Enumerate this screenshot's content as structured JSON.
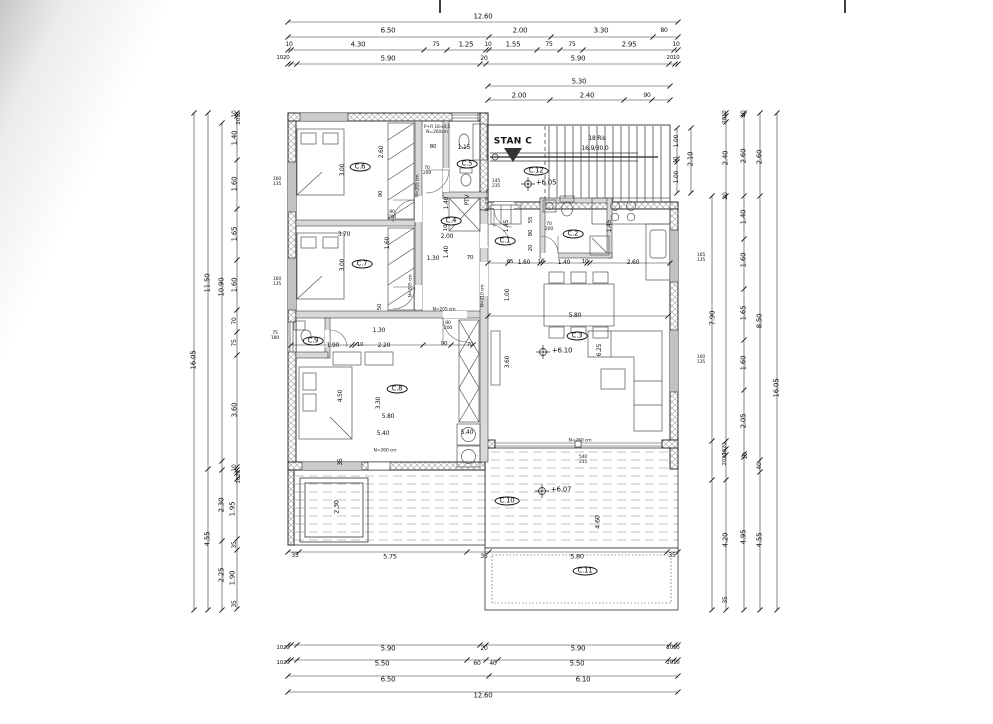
{
  "plan": {
    "title": "STAN C"
  },
  "stairs": {
    "line1": "18 Ris",
    "line2": "16.9/30.0"
  },
  "rooms": [
    "C.1",
    "C.2",
    "C.3",
    "C.4",
    "C.5",
    "C.6",
    "C.7",
    "C.8",
    "C.9",
    "C.10",
    "C.11",
    "C.12"
  ],
  "levels": [
    "+6.05",
    "+6.10",
    "+6.07"
  ],
  "colors": {
    "line": "#1a1a1a",
    "hatch": "#b0b0b0",
    "furniture": "#555555",
    "paper": "#ffffff"
  },
  "labels": [
    {
      "t": "12.60",
      "x": 483,
      "y": 17
    },
    {
      "t": "6.50",
      "x": 388,
      "y": 31
    },
    {
      "t": "2.00",
      "x": 520,
      "y": 31
    },
    {
      "t": "3.30",
      "x": 601,
      "y": 31
    },
    {
      "t": "80",
      "x": 664,
      "y": 31,
      "s": 6
    },
    {
      "t": "10",
      "x": 289,
      "y": 45,
      "s": 6
    },
    {
      "t": "4.30",
      "x": 358,
      "y": 45
    },
    {
      "t": "75",
      "x": 436,
      "y": 45,
      "s": 6
    },
    {
      "t": "1.25",
      "x": 466,
      "y": 45
    },
    {
      "t": "10",
      "x": 488,
      "y": 45,
      "s": 6
    },
    {
      "t": "1.55",
      "x": 513,
      "y": 45
    },
    {
      "t": "75",
      "x": 549,
      "y": 45,
      "s": 6
    },
    {
      "t": "75",
      "x": 572,
      "y": 45,
      "s": 6
    },
    {
      "t": "2.95",
      "x": 629,
      "y": 45
    },
    {
      "t": "10",
      "x": 676,
      "y": 45,
      "s": 6
    },
    {
      "t": "1020",
      "x": 283,
      "y": 59,
      "s": 5.5
    },
    {
      "t": "5.90",
      "x": 388,
      "y": 59
    },
    {
      "t": "20",
      "x": 484,
      "y": 59,
      "s": 6
    },
    {
      "t": "5.90",
      "x": 578,
      "y": 59
    },
    {
      "t": "2010",
      "x": 673,
      "y": 59,
      "s": 5.5
    },
    {
      "t": "5.30",
      "x": 579,
      "y": 82
    },
    {
      "t": "2.00",
      "x": 519,
      "y": 96
    },
    {
      "t": "2.40",
      "x": 587,
      "y": 96
    },
    {
      "t": "90",
      "x": 647,
      "y": 96,
      "s": 6
    },
    {
      "t": "1020",
      "x": 283,
      "y": 649,
      "s": 5.5
    },
    {
      "t": "5.90",
      "x": 388,
      "y": 649
    },
    {
      "t": "20",
      "x": 484,
      "y": 649,
      "s": 6
    },
    {
      "t": "5.90",
      "x": 578,
      "y": 649
    },
    {
      "t": "2010",
      "x": 673,
      "y": 649,
      "s": 5.5
    },
    {
      "t": "1020",
      "x": 283,
      "y": 664,
      "s": 5.5
    },
    {
      "t": "5.50",
      "x": 382,
      "y": 664
    },
    {
      "t": "60",
      "x": 477,
      "y": 664,
      "s": 6
    },
    {
      "t": "40",
      "x": 493,
      "y": 664,
      "s": 6
    },
    {
      "t": "5.50",
      "x": 577,
      "y": 664
    },
    {
      "t": "2010",
      "x": 673,
      "y": 664,
      "s": 5.5
    },
    {
      "t": "6.50",
      "x": 388,
      "y": 680
    },
    {
      "t": "6.10",
      "x": 583,
      "y": 680
    },
    {
      "t": "12.60",
      "x": 483,
      "y": 696
    },
    {
      "t": "16.05",
      "x": 194,
      "y": 360,
      "v": 1
    },
    {
      "t": "11.50",
      "x": 208,
      "y": 283,
      "v": 1
    },
    {
      "t": "4.55",
      "x": 208,
      "y": 539,
      "v": 1
    },
    {
      "t": "10.90",
      "x": 222,
      "y": 287,
      "v": 1
    },
    {
      "t": "2.30",
      "x": 222,
      "y": 505,
      "v": 1
    },
    {
      "t": "2.25",
      "x": 222,
      "y": 575,
      "v": 1
    },
    {
      "t": "2010",
      "x": 240,
      "y": 118,
      "v": 1,
      "s": 5.5
    },
    {
      "t": "10",
      "x": 235,
      "y": 114,
      "v": 1,
      "s": 6
    },
    {
      "t": "1.40",
      "x": 235,
      "y": 138,
      "v": 1
    },
    {
      "t": "1.60",
      "x": 235,
      "y": 184,
      "v": 1
    },
    {
      "t": "1.65",
      "x": 235,
      "y": 234,
      "v": 1
    },
    {
      "t": "1.60",
      "x": 235,
      "y": 285,
      "v": 1
    },
    {
      "t": "70",
      "x": 235,
      "y": 321,
      "v": 1,
      "s": 6
    },
    {
      "t": "75",
      "x": 235,
      "y": 343,
      "v": 1,
      "s": 6
    },
    {
      "t": "3.60",
      "x": 235,
      "y": 410,
      "v": 1
    },
    {
      "t": "10",
      "x": 235,
      "y": 468,
      "v": 1,
      "s": 6
    },
    {
      "t": "1020",
      "x": 240,
      "y": 477,
      "v": 1,
      "s": 5.5
    },
    {
      "t": "1.95",
      "x": 233,
      "y": 509,
      "v": 1
    },
    {
      "t": "35",
      "x": 235,
      "y": 545,
      "v": 1,
      "s": 6
    },
    {
      "t": "1.90",
      "x": 233,
      "y": 578,
      "v": 1
    },
    {
      "t": "35",
      "x": 235,
      "y": 604,
      "v": 1,
      "s": 6
    },
    {
      "t": "1.00",
      "x": 677,
      "y": 141,
      "v": 1,
      "s": 6
    },
    {
      "t": "10",
      "x": 677,
      "y": 160,
      "v": 1,
      "s": 5.5
    },
    {
      "t": "1.00",
      "x": 677,
      "y": 177,
      "v": 1,
      "s": 6
    },
    {
      "t": "2.10",
      "x": 691,
      "y": 159,
      "v": 1
    },
    {
      "t": "2010",
      "x": 726,
      "y": 117,
      "v": 1,
      "s": 5.5
    },
    {
      "t": "2.40",
      "x": 726,
      "y": 158,
      "v": 1
    },
    {
      "t": "20",
      "x": 726,
      "y": 196,
      "v": 1,
      "s": 6
    },
    {
      "t": "7.90",
      "x": 713,
      "y": 318,
      "v": 1
    },
    {
      "t": "1020",
      "x": 726,
      "y": 449,
      "v": 1,
      "s": 5.5
    },
    {
      "t": "2020",
      "x": 726,
      "y": 459,
      "v": 1,
      "s": 5.5
    },
    {
      "t": "4.20",
      "x": 726,
      "y": 540,
      "v": 1
    },
    {
      "t": "35",
      "x": 726,
      "y": 600,
      "v": 1,
      "s": 6
    },
    {
      "t": "10",
      "x": 744,
      "y": 114,
      "v": 1,
      "s": 6
    },
    {
      "t": "2.60",
      "x": 744,
      "y": 156,
      "v": 1
    },
    {
      "t": "1.40",
      "x": 744,
      "y": 217,
      "v": 1
    },
    {
      "t": "1.60",
      "x": 744,
      "y": 260,
      "v": 1
    },
    {
      "t": "1.65",
      "x": 744,
      "y": 313,
      "v": 1
    },
    {
      "t": "1.60",
      "x": 744,
      "y": 363,
      "v": 1
    },
    {
      "t": "2.05",
      "x": 744,
      "y": 421,
      "v": 1
    },
    {
      "t": "10",
      "x": 746,
      "y": 456,
      "v": 1,
      "s": 6
    },
    {
      "t": "4.95",
      "x": 744,
      "y": 537,
      "v": 1
    },
    {
      "t": "2.60",
      "x": 760,
      "y": 157,
      "v": 1
    },
    {
      "t": "8.50",
      "x": 760,
      "y": 321,
      "v": 1
    },
    {
      "t": "40",
      "x": 760,
      "y": 466,
      "v": 1,
      "s": 6
    },
    {
      "t": "4.55",
      "x": 760,
      "y": 540,
      "v": 1
    },
    {
      "t": "16.05",
      "x": 777,
      "y": 388,
      "v": 1
    },
    {
      "t": "C.1",
      "x": 505,
      "y": 241,
      "k": "room"
    },
    {
      "t": "C.2",
      "x": 573,
      "y": 234,
      "k": "room"
    },
    {
      "t": "C.3",
      "x": 577,
      "y": 336,
      "k": "room"
    },
    {
      "t": "C.4",
      "x": 451,
      "y": 221,
      "k": "room"
    },
    {
      "t": "C.5",
      "x": 467,
      "y": 164,
      "k": "room"
    },
    {
      "t": "C.6",
      "x": 360,
      "y": 167,
      "k": "room"
    },
    {
      "t": "C.7",
      "x": 362,
      "y": 264,
      "k": "room"
    },
    {
      "t": "C.8",
      "x": 397,
      "y": 389,
      "k": "room"
    },
    {
      "t": "C.9",
      "x": 313,
      "y": 341,
      "k": "room"
    },
    {
      "t": "C.10",
      "x": 507,
      "y": 501,
      "k": "room"
    },
    {
      "t": "C.11",
      "x": 585,
      "y": 571,
      "k": "room"
    },
    {
      "t": "C.12",
      "x": 536,
      "y": 171,
      "k": "room"
    },
    {
      "t": "+6.05",
      "x": 546,
      "y": 183,
      "k": "level"
    },
    {
      "t": "+6.10",
      "x": 562,
      "y": 351,
      "k": "level"
    },
    {
      "t": "+6.07",
      "x": 561,
      "y": 490,
      "k": "level"
    },
    {
      "t": "3.70",
      "x": 344,
      "y": 235,
      "s": 6
    },
    {
      "t": "80",
      "x": 433,
      "y": 148,
      "s": 5.5
    },
    {
      "t": "1.15",
      "x": 464,
      "y": 148,
      "s": 6
    },
    {
      "t": "2.00",
      "x": 447,
      "y": 237,
      "s": 6
    },
    {
      "t": "1.30",
      "x": 433,
      "y": 259,
      "s": 6
    },
    {
      "t": "70",
      "x": 470,
      "y": 259,
      "s": 5.5
    },
    {
      "t": "65",
      "x": 510,
      "y": 263,
      "s": 5.5
    },
    {
      "t": "1.60",
      "x": 524,
      "y": 263,
      "s": 6
    },
    {
      "t": "10",
      "x": 541,
      "y": 263,
      "s": 5.5
    },
    {
      "t": "1.40",
      "x": 564,
      "y": 263,
      "s": 6
    },
    {
      "t": "10",
      "x": 585,
      "y": 263,
      "s": 5.5
    },
    {
      "t": "2.60",
      "x": 633,
      "y": 263,
      "s": 6
    },
    {
      "t": "1.90",
      "x": 333,
      "y": 346,
      "s": 6
    },
    {
      "t": "10",
      "x": 360,
      "y": 346,
      "s": 5.5
    },
    {
      "t": "2.20",
      "x": 384,
      "y": 346,
      "s": 6
    },
    {
      "t": "90",
      "x": 444,
      "y": 345,
      "s": 5.5
    },
    {
      "t": "70",
      "x": 470,
      "y": 346,
      "s": 5.5
    },
    {
      "t": "1.30",
      "x": 379,
      "y": 331,
      "s": 6
    },
    {
      "t": "5.80",
      "x": 575,
      "y": 316,
      "s": 6
    },
    {
      "t": "5.80",
      "x": 388,
      "y": 417,
      "s": 6
    },
    {
      "t": "5.40",
      "x": 383,
      "y": 434,
      "s": 6
    },
    {
      "t": "5.40",
      "x": 467,
      "y": 433,
      "s": 6
    },
    {
      "t": "5.75",
      "x": 390,
      "y": 557,
      "s": 6.5
    },
    {
      "t": "5.80",
      "x": 577,
      "y": 557,
      "s": 6.5
    },
    {
      "t": "35",
      "x": 295,
      "y": 556,
      "s": 6
    },
    {
      "t": "35",
      "x": 484,
      "y": 557,
      "s": 6
    },
    {
      "t": "35",
      "x": 672,
      "y": 556,
      "s": 6
    },
    {
      "t": "3.00",
      "x": 343,
      "y": 170,
      "v": 1,
      "s": 6
    },
    {
      "t": "2.60",
      "x": 382,
      "y": 152,
      "v": 1,
      "s": 6
    },
    {
      "t": "90",
      "x": 382,
      "y": 194,
      "v": 1,
      "s": 5.5
    },
    {
      "t": "3.00",
      "x": 343,
      "y": 265,
      "v": 1,
      "s": 6
    },
    {
      "t": "1.60",
      "x": 388,
      "y": 243,
      "v": 1,
      "s": 6
    },
    {
      "t": "1.40",
      "x": 447,
      "y": 203,
      "v": 1,
      "s": 6
    },
    {
      "t": "10",
      "x": 447,
      "y": 228,
      "v": 1,
      "s": 5.5
    },
    {
      "t": "1.40",
      "x": 447,
      "y": 252,
      "v": 1,
      "s": 6
    },
    {
      "t": "1.45",
      "x": 507,
      "y": 226,
      "v": 1,
      "s": 6
    },
    {
      "t": "55",
      "x": 532,
      "y": 220,
      "v": 1,
      "s": 5.5
    },
    {
      "t": "80",
      "x": 532,
      "y": 233,
      "v": 1,
      "s": 5.5
    },
    {
      "t": "20",
      "x": 532,
      "y": 248,
      "v": 1,
      "s": 5.5
    },
    {
      "t": "1.45",
      "x": 610,
      "y": 226,
      "v": 1,
      "s": 6
    },
    {
      "t": "1.00",
      "x": 508,
      "y": 295,
      "v": 1,
      "s": 6
    },
    {
      "t": "3.60",
      "x": 508,
      "y": 362,
      "v": 1,
      "s": 6
    },
    {
      "t": "6.25",
      "x": 600,
      "y": 350,
      "v": 1,
      "s": 6
    },
    {
      "t": "4.50",
      "x": 341,
      "y": 396,
      "v": 1,
      "s": 6
    },
    {
      "t": "3.30",
      "x": 379,
      "y": 403,
      "v": 1,
      "s": 6
    },
    {
      "t": "50",
      "x": 381,
      "y": 307,
      "v": 1,
      "s": 5.5
    },
    {
      "t": "2.30",
      "x": 337,
      "y": 507,
      "v": 1,
      "s": 6.5
    },
    {
      "t": "4.60",
      "x": 598,
      "y": 522,
      "v": 1,
      "s": 6.5
    },
    {
      "t": "35",
      "x": 341,
      "y": 462,
      "v": 1,
      "s": 6
    },
    {
      "t": "N=235 cm",
      "x": 489,
      "y": 200,
      "v": 1,
      "k": "note"
    },
    {
      "t": "N=205 cm",
      "x": 419,
      "y": 186,
      "v": 1,
      "k": "note"
    },
    {
      "t": "N=205 cm",
      "x": 412,
      "y": 286,
      "v": 1,
      "k": "note"
    },
    {
      "t": "N=210 cm",
      "x": 484,
      "y": 296,
      "v": 1,
      "k": "note"
    },
    {
      "t": "N=260 cm",
      "x": 385,
      "y": 452,
      "k": "note"
    },
    {
      "t": "N=260 cm",
      "x": 580,
      "y": 442,
      "k": "note"
    },
    {
      "t": "N=205 cm",
      "x": 444,
      "y": 311,
      "k": "note"
    },
    {
      "t": "P+R 16×4,5\nN=260cm",
      "x": 437,
      "y": 131,
      "k": "note"
    },
    {
      "t": "PTV",
      "x": 468,
      "y": 200,
      "v": 1,
      "s": 6
    },
    {
      "t": "160\n135",
      "x": 277,
      "y": 183,
      "k": "tag"
    },
    {
      "t": "160\n135",
      "x": 277,
      "y": 283,
      "k": "tag"
    },
    {
      "t": "75\n180",
      "x": 275,
      "y": 337,
      "k": "tag"
    },
    {
      "t": "165\n135",
      "x": 701,
      "y": 259,
      "k": "tag"
    },
    {
      "t": "160\n135",
      "x": 701,
      "y": 361,
      "k": "tag"
    },
    {
      "t": "540\n235",
      "x": 583,
      "y": 461,
      "k": "tag"
    },
    {
      "t": "70\n200",
      "x": 427,
      "y": 172,
      "k": "tag"
    },
    {
      "t": "70\n200",
      "x": 549,
      "y": 228,
      "k": "tag"
    },
    {
      "t": "80\n200",
      "x": 392,
      "y": 216,
      "k": "tag"
    },
    {
      "t": "80\n200",
      "x": 448,
      "y": 327,
      "k": "tag"
    },
    {
      "t": "145\n235",
      "x": 496,
      "y": 185,
      "k": "tag"
    }
  ],
  "dim_lines": {
    "h": [
      {
        "y": 22,
        "ticks": [
          288,
          678
        ]
      },
      {
        "y": 37,
        "ticks": [
          288,
          489,
          551,
          653,
          678
        ]
      },
      {
        "y": 50,
        "ticks": [
          288,
          291,
          424,
          447,
          486,
          489,
          537,
          560,
          583,
          674,
          678
        ]
      },
      {
        "y": 64,
        "ticks": [
          288,
          291,
          297,
          480,
          486,
          669,
          675,
          678
        ]
      },
      {
        "y": 86,
        "ticks": [
          488,
          670
        ]
      },
      {
        "y": 100,
        "ticks": [
          488,
          550,
          624,
          652,
          670
        ]
      },
      {
        "y": 316,
        "ticks": [
          488,
          668
        ]
      },
      {
        "y": 345,
        "ticks": [
          291,
          352,
          355,
          423,
          451,
          473
        ]
      },
      {
        "y": 263,
        "x1": 488,
        "x2": 670,
        "ticks": [
          488,
          508,
          540,
          543,
          587,
          590,
          670
        ]
      },
      {
        "y": 552,
        "ticks": [
          288,
          299,
          467,
          489,
          667,
          678
        ]
      },
      {
        "y": 645,
        "ticks": [
          288,
          291,
          297,
          480,
          486,
          669,
          675,
          678
        ]
      },
      {
        "y": 660,
        "ticks": [
          288,
          291,
          297,
          467,
          486,
          498,
          668,
          674,
          678
        ]
      },
      {
        "y": 676,
        "ticks": [
          288,
          489,
          678
        ]
      },
      {
        "y": 692,
        "ticks": [
          288,
          678
        ]
      }
    ],
    "v": [
      {
        "x": 194,
        "ticks": [
          113,
          610
        ]
      },
      {
        "x": 208,
        "ticks": [
          113,
          469,
          610
        ]
      },
      {
        "x": 222,
        "ticks": [
          123,
          461,
          470,
          541,
          610
        ]
      },
      {
        "x": 237,
        "ticks": [
          113,
          116,
          160,
          209,
          260,
          310,
          332,
          355,
          467,
          470,
          473,
          479,
          539,
          550,
          609
        ]
      },
      {
        "x": 677,
        "ticks": [
          128,
          159,
          162,
          193
        ]
      },
      {
        "x": 691,
        "ticks": [
          128,
          193
        ]
      },
      {
        "x": 712,
        "ticks": [
          196,
          441,
          480,
          610
        ]
      },
      {
        "x": 726,
        "ticks": [
          113,
          116,
          122,
          196,
          441,
          449,
          455,
          480,
          610
        ]
      },
      {
        "x": 744,
        "ticks": [
          113,
          115,
          196,
          239,
          289,
          340,
          390,
          454,
          457,
          610
        ]
      },
      {
        "x": 760,
        "ticks": [
          113,
          196,
          460,
          472,
          610
        ]
      },
      {
        "x": 777,
        "ticks": [
          113,
          610
        ]
      }
    ]
  }
}
